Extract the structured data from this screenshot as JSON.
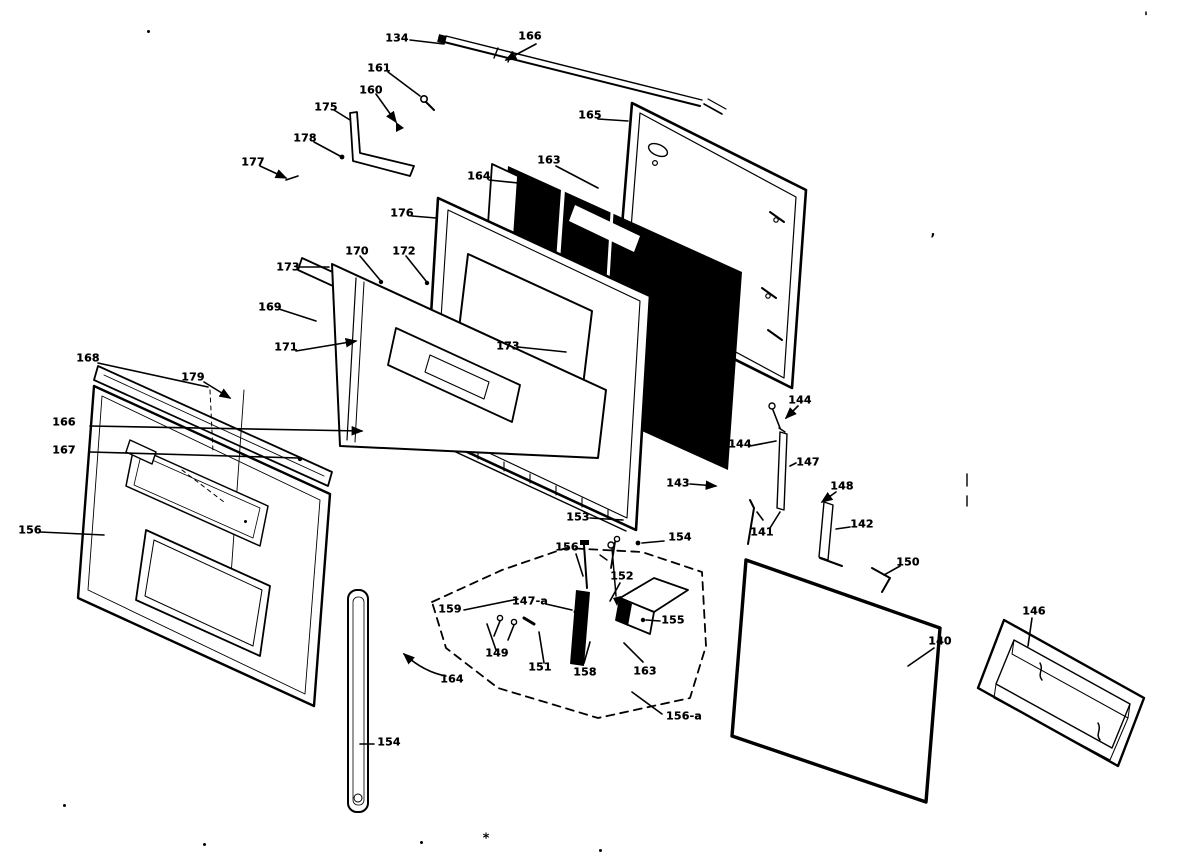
{
  "diagram": {
    "kind": "exploded-parts-diagram",
    "callouts": [
      {
        "label": "134"
      },
      {
        "label": "166"
      },
      {
        "label": "161"
      },
      {
        "label": "160"
      },
      {
        "label": "175"
      },
      {
        "label": "178"
      },
      {
        "label": "177"
      },
      {
        "label": "165"
      },
      {
        "label": "163"
      },
      {
        "label": "164"
      },
      {
        "label": "176"
      },
      {
        "label": "170"
      },
      {
        "label": "172"
      },
      {
        "label": "173"
      },
      {
        "label": "169"
      },
      {
        "label": "171"
      },
      {
        "label": "173"
      },
      {
        "label": "168"
      },
      {
        "label": "179"
      },
      {
        "label": "166"
      },
      {
        "label": "167"
      },
      {
        "label": "156"
      },
      {
        "label": "153"
      },
      {
        "label": "154"
      },
      {
        "label": "156"
      },
      {
        "label": "152"
      },
      {
        "label": "159"
      },
      {
        "label": "147-a"
      },
      {
        "label": "149"
      },
      {
        "label": "151"
      },
      {
        "label": "158"
      },
      {
        "label": "163"
      },
      {
        "label": "155"
      },
      {
        "label": "156-a"
      },
      {
        "label": "164"
      },
      {
        "label": "154"
      },
      {
        "label": "144"
      },
      {
        "label": "144"
      },
      {
        "label": "147"
      },
      {
        "label": "143"
      },
      {
        "label": "148"
      },
      {
        "label": "141"
      },
      {
        "label": "142"
      },
      {
        "label": "150"
      },
      {
        "label": "140"
      },
      {
        "label": "146"
      }
    ],
    "stray_marks": [
      "'",
      ",",
      "*"
    ]
  }
}
